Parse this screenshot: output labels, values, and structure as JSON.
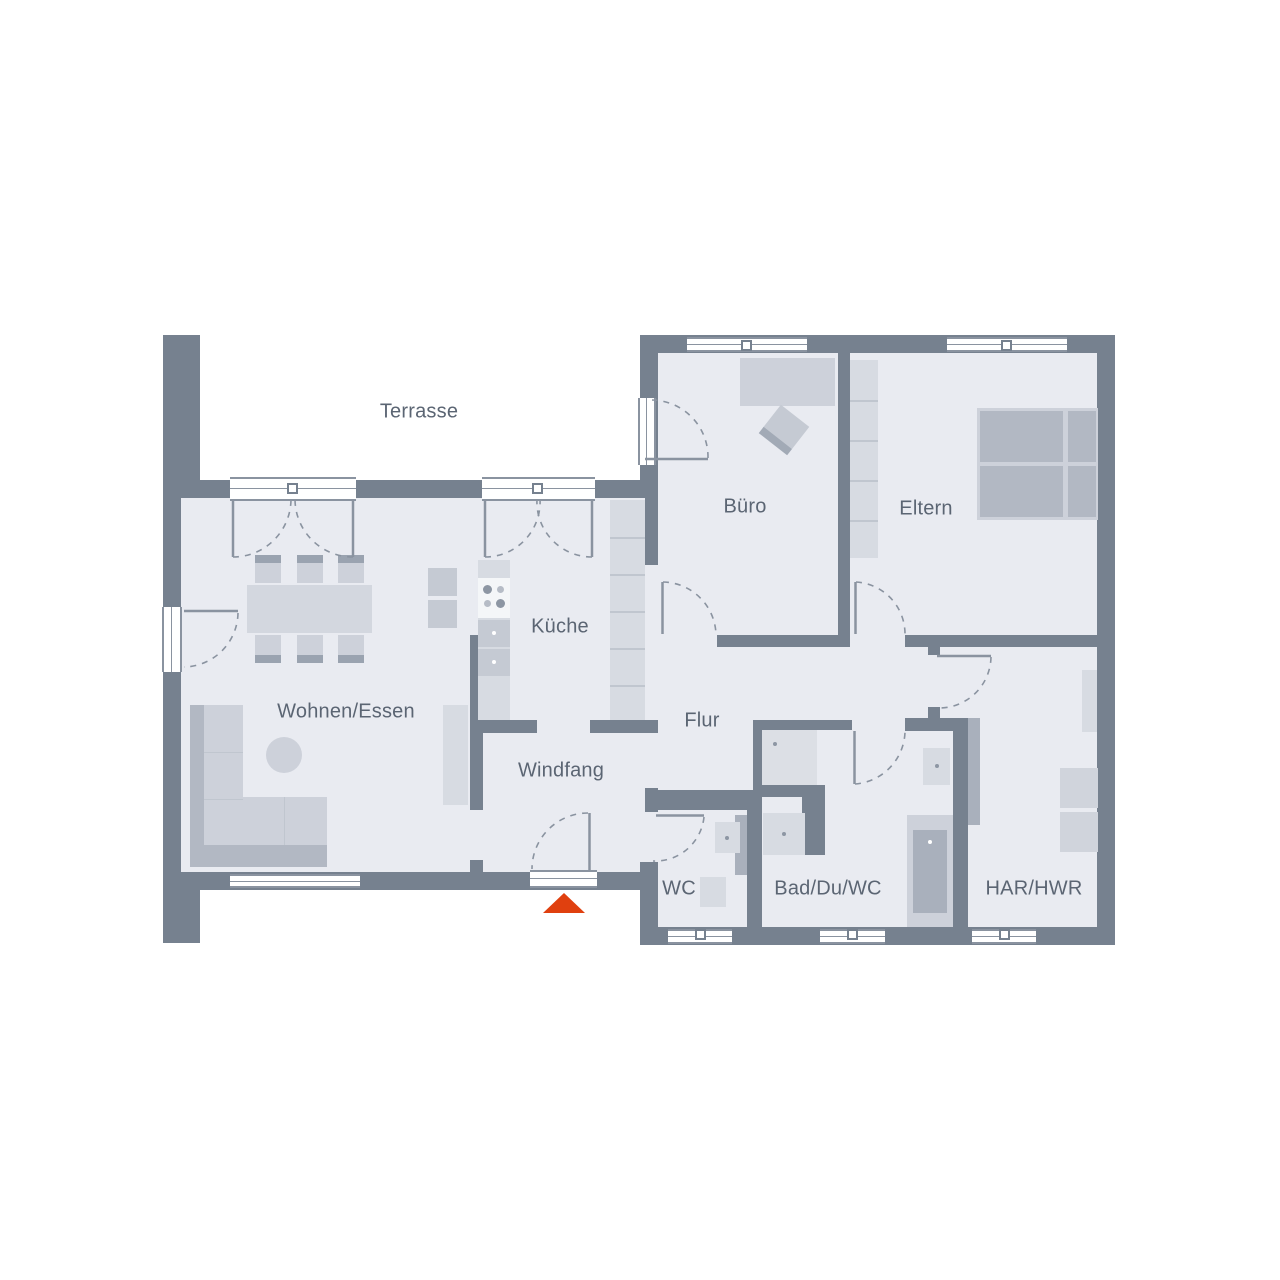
{
  "plan": {
    "title": "floor-plan",
    "rooms": {
      "terrasse": "Terrasse",
      "buero": "Büro",
      "eltern": "Eltern",
      "kueche": "Küche",
      "wohnen_essen": "Wohnen/Essen",
      "flur": "Flur",
      "windfang": "Windfang",
      "wc": "WC",
      "bad_du_wc": "Bad/Du/WC",
      "har_hwr": "HAR/HWR"
    },
    "entrance_marker": {
      "icon": "entrance-arrow-icon",
      "color": "#e0400f"
    },
    "colors": {
      "wall": "#76818f",
      "floor": "#e9ebf1",
      "furniture_light": "#d7dbe2",
      "furniture_dark": "#b2b8c3",
      "label_text": "#5b6573",
      "background": "#ffffff"
    }
  }
}
